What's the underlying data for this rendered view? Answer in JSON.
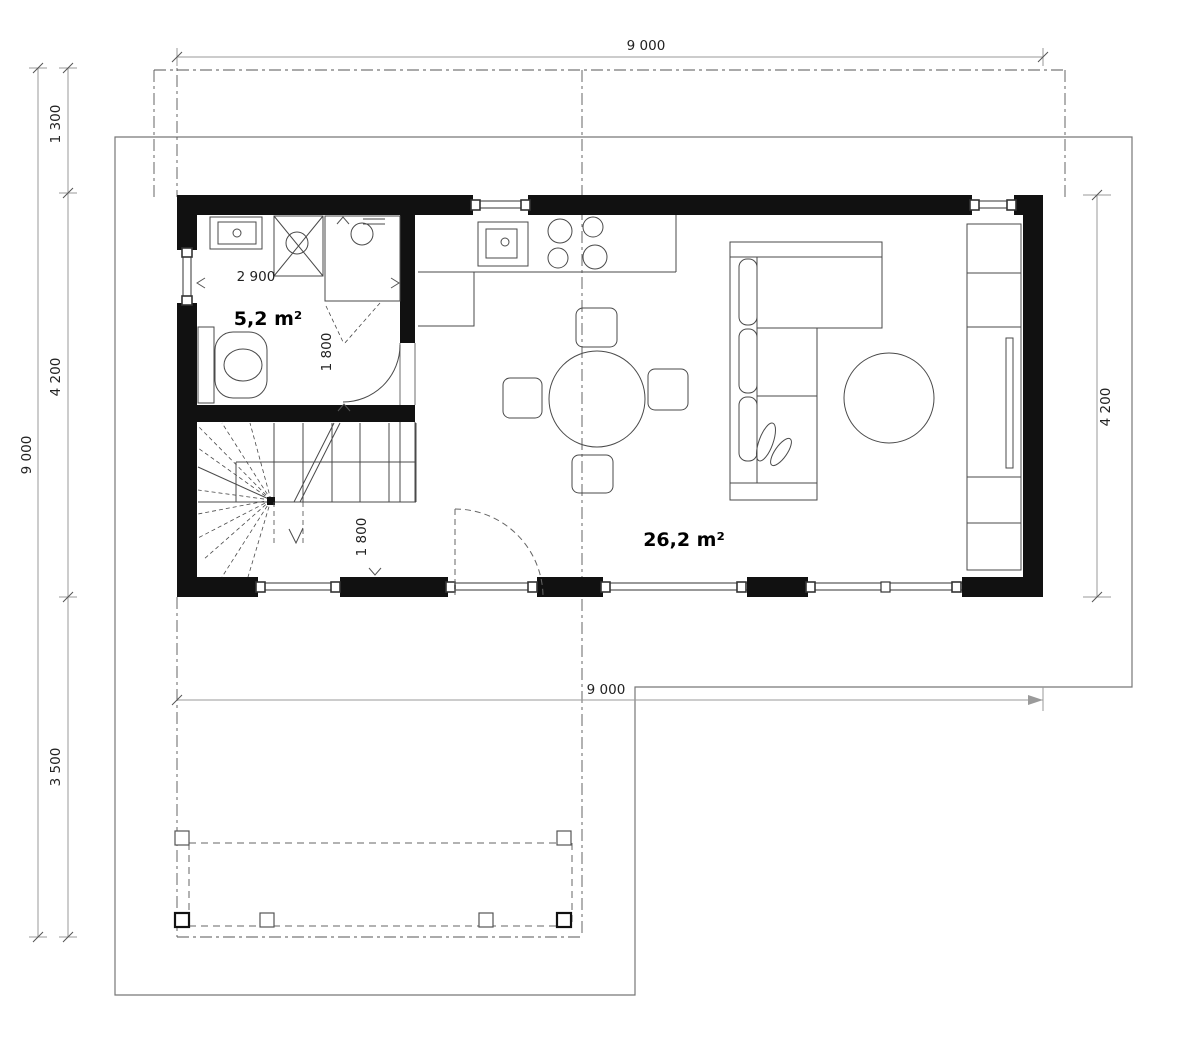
{
  "labels": {
    "bathroom_area": "5,2 m²",
    "living_area": "26,2 m²"
  },
  "dimensions": {
    "top_overall_width": "9 000",
    "left_overall_depth": "9 000",
    "left_roof_overhang": "1 300",
    "left_house_depth": "4 200",
    "left_terrace_depth": "3 500",
    "right_house_depth": "4 200",
    "terrace_level_width": "9 000",
    "bathroom_width": "2 900",
    "bathroom_clearance": "1 800",
    "hall_clearance": "1 800"
  },
  "colors": {
    "wall": "#111111",
    "furniture_line": "#555555",
    "dimension_line": "#9a9a9a",
    "dimension_text": "#222222",
    "site_line": "#777777",
    "background": "#ffffff"
  }
}
